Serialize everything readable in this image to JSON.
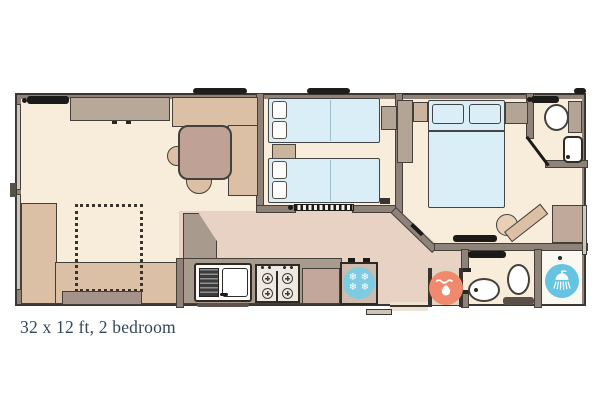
{
  "caption": "32 x 12 ft, 2 bedroom",
  "icons": {
    "fridge_freezer": "snowflake-circle",
    "boiler": "flame-circle",
    "shower": "shower-head-circle",
    "snowflake_glyph": "❄"
  },
  "colors": {
    "floor_light": "#f8ecdb",
    "floor_hall": "#e7d2c3",
    "wall": "#8e8279",
    "outline": "#44403a",
    "sofa_tan": "#dcc0a5",
    "sofa_gray": "#b7a899",
    "table_mauve": "#bfa295",
    "bed_blue": "#d9eef6",
    "wardrobe_dark": "#b3a496",
    "wardrobe_light": "#cbb49e",
    "worktop": "#a89a8c",
    "cabinet_mauve": "#c3a79a",
    "fridge_blue": "#7ecbe2",
    "shower_blue": "#66c4e2",
    "boiler_orange": "#ef8a6e",
    "radiator_black": "#1c1a18",
    "caption_text": "#33475b"
  }
}
